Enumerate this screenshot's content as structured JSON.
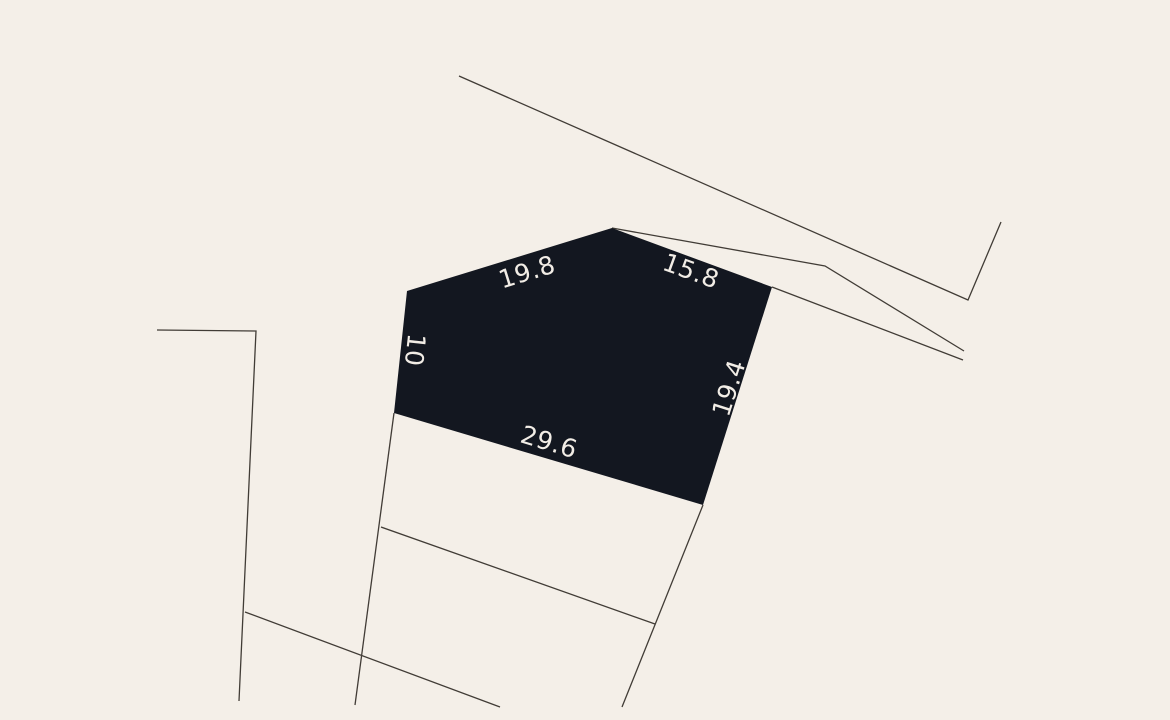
{
  "map": {
    "background_color": "#f4efe8",
    "boundary_color": "#413c36",
    "parcel": {
      "fill_color": "#131720",
      "label_color": "#f2ede6",
      "points": [
        [
          394,
          413
        ],
        [
          407,
          291
        ],
        [
          612,
          228
        ],
        [
          772,
          287
        ],
        [
          703,
          505
        ]
      ],
      "edge_labels": [
        {
          "text": "19.8",
          "x": 527,
          "y": 272,
          "angle": -17.2
        },
        {
          "text": "15.8",
          "x": 691,
          "y": 271,
          "angle": 20.1
        },
        {
          "text": "10",
          "x": 415,
          "y": 350,
          "angle": 96.1
        },
        {
          "text": "19.4",
          "x": 729,
          "y": 388,
          "angle": -72.4
        },
        {
          "text": "29.6",
          "x": 549,
          "y": 442,
          "angle": 16.6
        }
      ]
    },
    "boundaries": [
      {
        "name": "street-boundary-upper",
        "points": [
          [
            459,
            76
          ],
          [
            968,
            300
          ],
          [
            1001,
            222
          ]
        ]
      },
      {
        "name": "wedge-boundary-upper",
        "points": [
          [
            612,
            228
          ],
          [
            825,
            266
          ],
          [
            964,
            351
          ]
        ]
      },
      {
        "name": "wedge-boundary-lower",
        "points": [
          [
            772,
            287
          ],
          [
            963,
            360
          ]
        ]
      },
      {
        "name": "neighbor-boundary-left",
        "points": [
          [
            157,
            330
          ],
          [
            256,
            331
          ],
          [
            239,
            701
          ]
        ]
      },
      {
        "name": "neighbor-diagonal-left",
        "points": [
          [
            245,
            612
          ],
          [
            500,
            707
          ]
        ]
      },
      {
        "name": "neighbor-boundary-below-left",
        "points": [
          [
            394,
            413
          ],
          [
            355,
            705
          ]
        ]
      },
      {
        "name": "neighbor-diagonal-below",
        "points": [
          [
            381,
            527
          ],
          [
            655,
            624
          ]
        ]
      },
      {
        "name": "neighbor-boundary-below-right",
        "points": [
          [
            703,
            505
          ],
          [
            622,
            707
          ]
        ]
      }
    ]
  }
}
